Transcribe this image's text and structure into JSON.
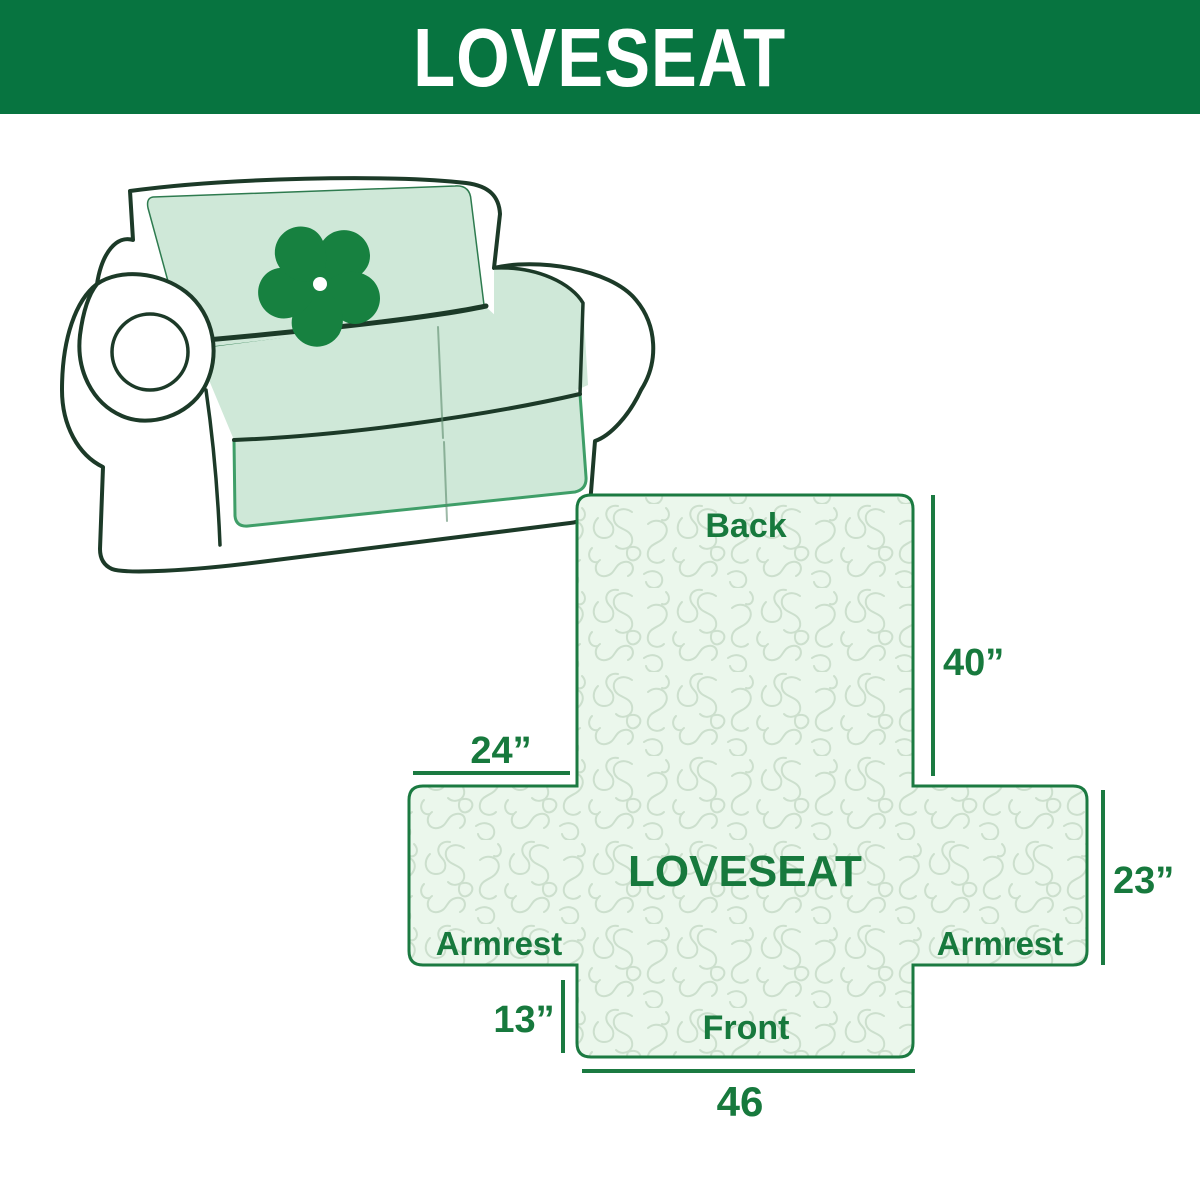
{
  "header": {
    "title": "LOVESEAT"
  },
  "illustration": {
    "name": "loveseat sofa with protective cover",
    "logo": "pinwheel"
  },
  "diagram": {
    "center_label": "LOVESEAT",
    "back_label": "Back",
    "front_label": "Front",
    "armrest_left_label": "Armrest",
    "armrest_right_label": "Armrest",
    "dim_back_height": "40”",
    "dim_armrest_width": "24”",
    "dim_side_height": "23”",
    "dim_front_height": "13”",
    "dim_front_width": "46"
  },
  "colors": {
    "header_green": "#077440",
    "label_green": "#17793D",
    "diagram_stroke_green": "#1B7A41",
    "diagram_fill": "#EBF7EC",
    "squiggle": "#CCDFCD",
    "sofa_outline": "#1C3A28",
    "sofa_cover_mint": "#CFE8D8",
    "logo_green": "#178140"
  }
}
